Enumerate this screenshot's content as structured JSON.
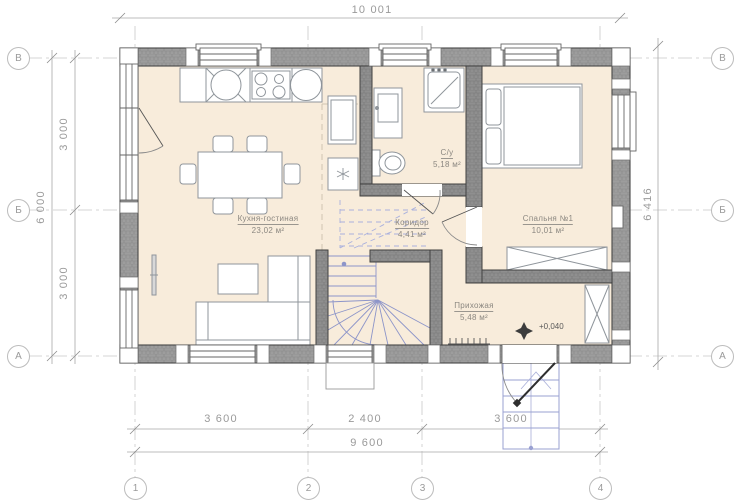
{
  "plan": {
    "rooms": {
      "kitchen_living": {
        "name": "Кухня-гостиная",
        "area": "23,02 м²"
      },
      "bathroom": {
        "name": "С/у",
        "area": "5,18 м²"
      },
      "corridor": {
        "name": "Коридор",
        "area": "4,41 м²"
      },
      "bedroom": {
        "name": "Спальня №1",
        "area": "10,01 м²"
      },
      "entry_hall": {
        "name": "Прихожая",
        "area": "5,48 м²"
      }
    },
    "level_mark": "+0,040"
  },
  "dimensions": {
    "top_total": "10 001",
    "right_total": "6 416",
    "left_total": "6 000",
    "left_upper": "3 000",
    "left_lower": "3 000",
    "bottom_1": "3 600",
    "bottom_2": "2 400",
    "bottom_3": "3 600",
    "bottom_total": "9 600"
  },
  "axes": {
    "row_top": "В",
    "row_mid": "Б",
    "row_bottom": "А",
    "col_1": "1",
    "col_2": "2",
    "col_3": "3",
    "col_4": "4"
  },
  "colors": {
    "floor": "#f8ecdb",
    "wall": "#9d9d9d",
    "wall_outline": "#474747",
    "stairs_blue": "#8d95c9",
    "dimension_text": "#9a9a9a",
    "label_text": "#8b8780"
  }
}
